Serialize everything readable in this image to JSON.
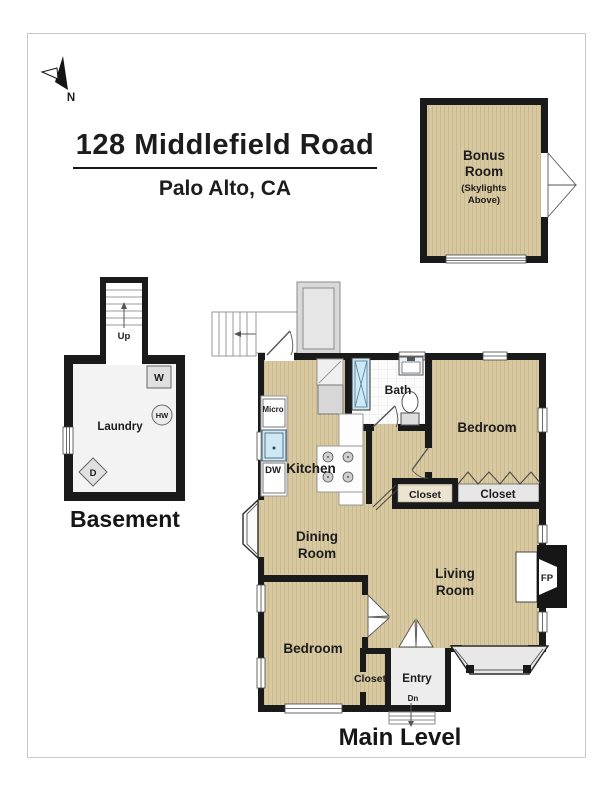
{
  "title": {
    "line1": "128 Middlefield Road",
    "line2": "Palo Alto, CA"
  },
  "compass": {
    "north": "N"
  },
  "bonus_room": {
    "line1": "Bonus",
    "line2": "Room",
    "note1": "(Skylights",
    "note2": "Above)"
  },
  "basement": {
    "caption": "Basement",
    "stairs": "Up",
    "room": "Laundry",
    "washer": "W",
    "water_heater": "HW",
    "dryer": "D"
  },
  "main_level": {
    "caption": "Main Level",
    "stairs": "Dn",
    "micro": "Micro",
    "dishwasher": "DW",
    "kitchen": "Kitchen",
    "bath": "Bath",
    "bedroom_upper": "Bedroom",
    "closet_hall": "Closet",
    "closet_bedroom": "Closet",
    "dining1": "Dining",
    "dining2": "Room",
    "living1": "Living",
    "living2": "Room",
    "fireplace": "FP",
    "bedroom_lower": "Bedroom",
    "closet_lower": "Closet",
    "entry": "Entry",
    "entry_down": "Dn"
  },
  "colors": {
    "wood_floor": "#d8c9a0",
    "wood_stripe": "#c9b890",
    "wall": "#1a1a1a",
    "light_floor": "#f3f3f3",
    "fixture_gray": "#e0e0e0",
    "shower_blue": "#cde9f5"
  }
}
